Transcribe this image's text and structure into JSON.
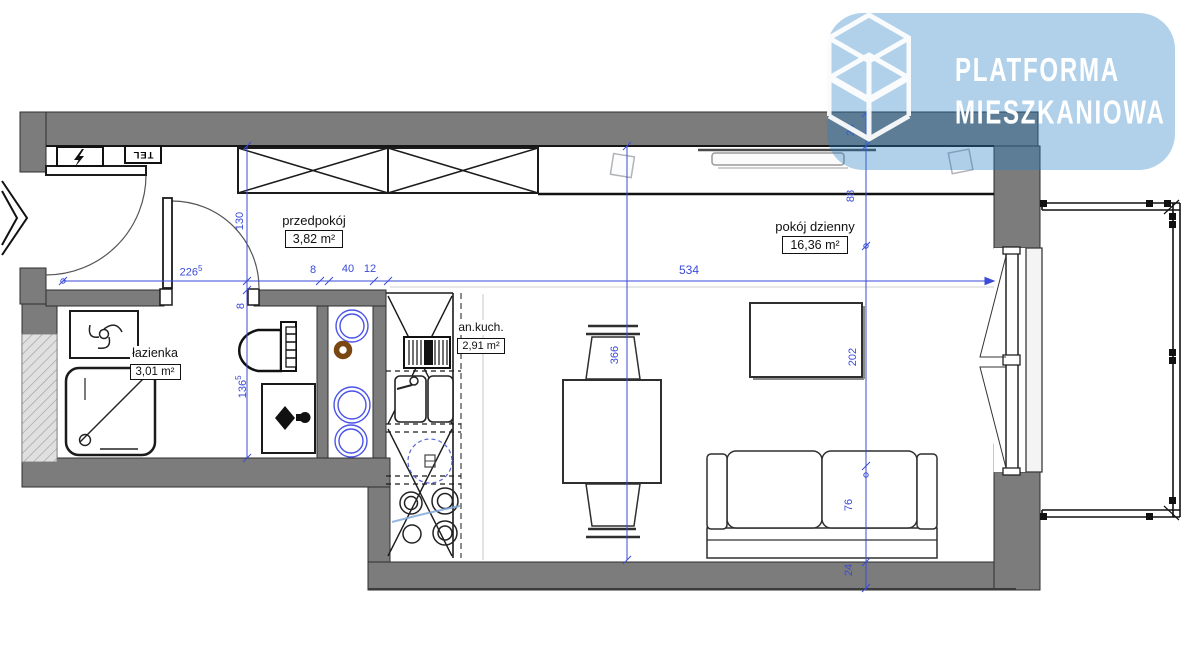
{
  "logo": {
    "line1": "PLATFORMA",
    "line2": "MIESZKANIOWA"
  },
  "rooms": {
    "hall": {
      "name": "przedpokój",
      "area": "3,82 m²"
    },
    "living": {
      "name": "pokój dzienny",
      "area": "16,36 m²"
    },
    "bath": {
      "name": "łazienka",
      "area": "3,01 m²"
    },
    "kitchen": {
      "name": "an.kuch.",
      "area": "2,91 m²"
    }
  },
  "labels": {
    "tel": "TEL"
  },
  "dims": {
    "hall_width": {
      "v": "226",
      "sup": "5"
    },
    "seg8": {
      "v": "8"
    },
    "seg40": {
      "v": "40"
    },
    "seg12": {
      "v": "12"
    },
    "living_width": {
      "v": "534"
    },
    "hall_height": {
      "v": "130"
    },
    "wall8": {
      "v": "8"
    },
    "bath_height": {
      "v": "136",
      "sup": "5"
    },
    "living_height": {
      "v": "366"
    },
    "wall_top": {
      "v": "24"
    },
    "offset88": {
      "v": "88"
    },
    "span202": {
      "v": "202"
    },
    "sofa76": {
      "v": "76"
    },
    "wall_bottom": {
      "v": "24"
    }
  },
  "colors": {
    "dimension_blue": "#3a4bd8",
    "logo_blue": "#2680c8",
    "wall_gray": "#7c7c7c",
    "pipe_blue": "#4953e8",
    "pipe_brown": "#7a4612"
  }
}
